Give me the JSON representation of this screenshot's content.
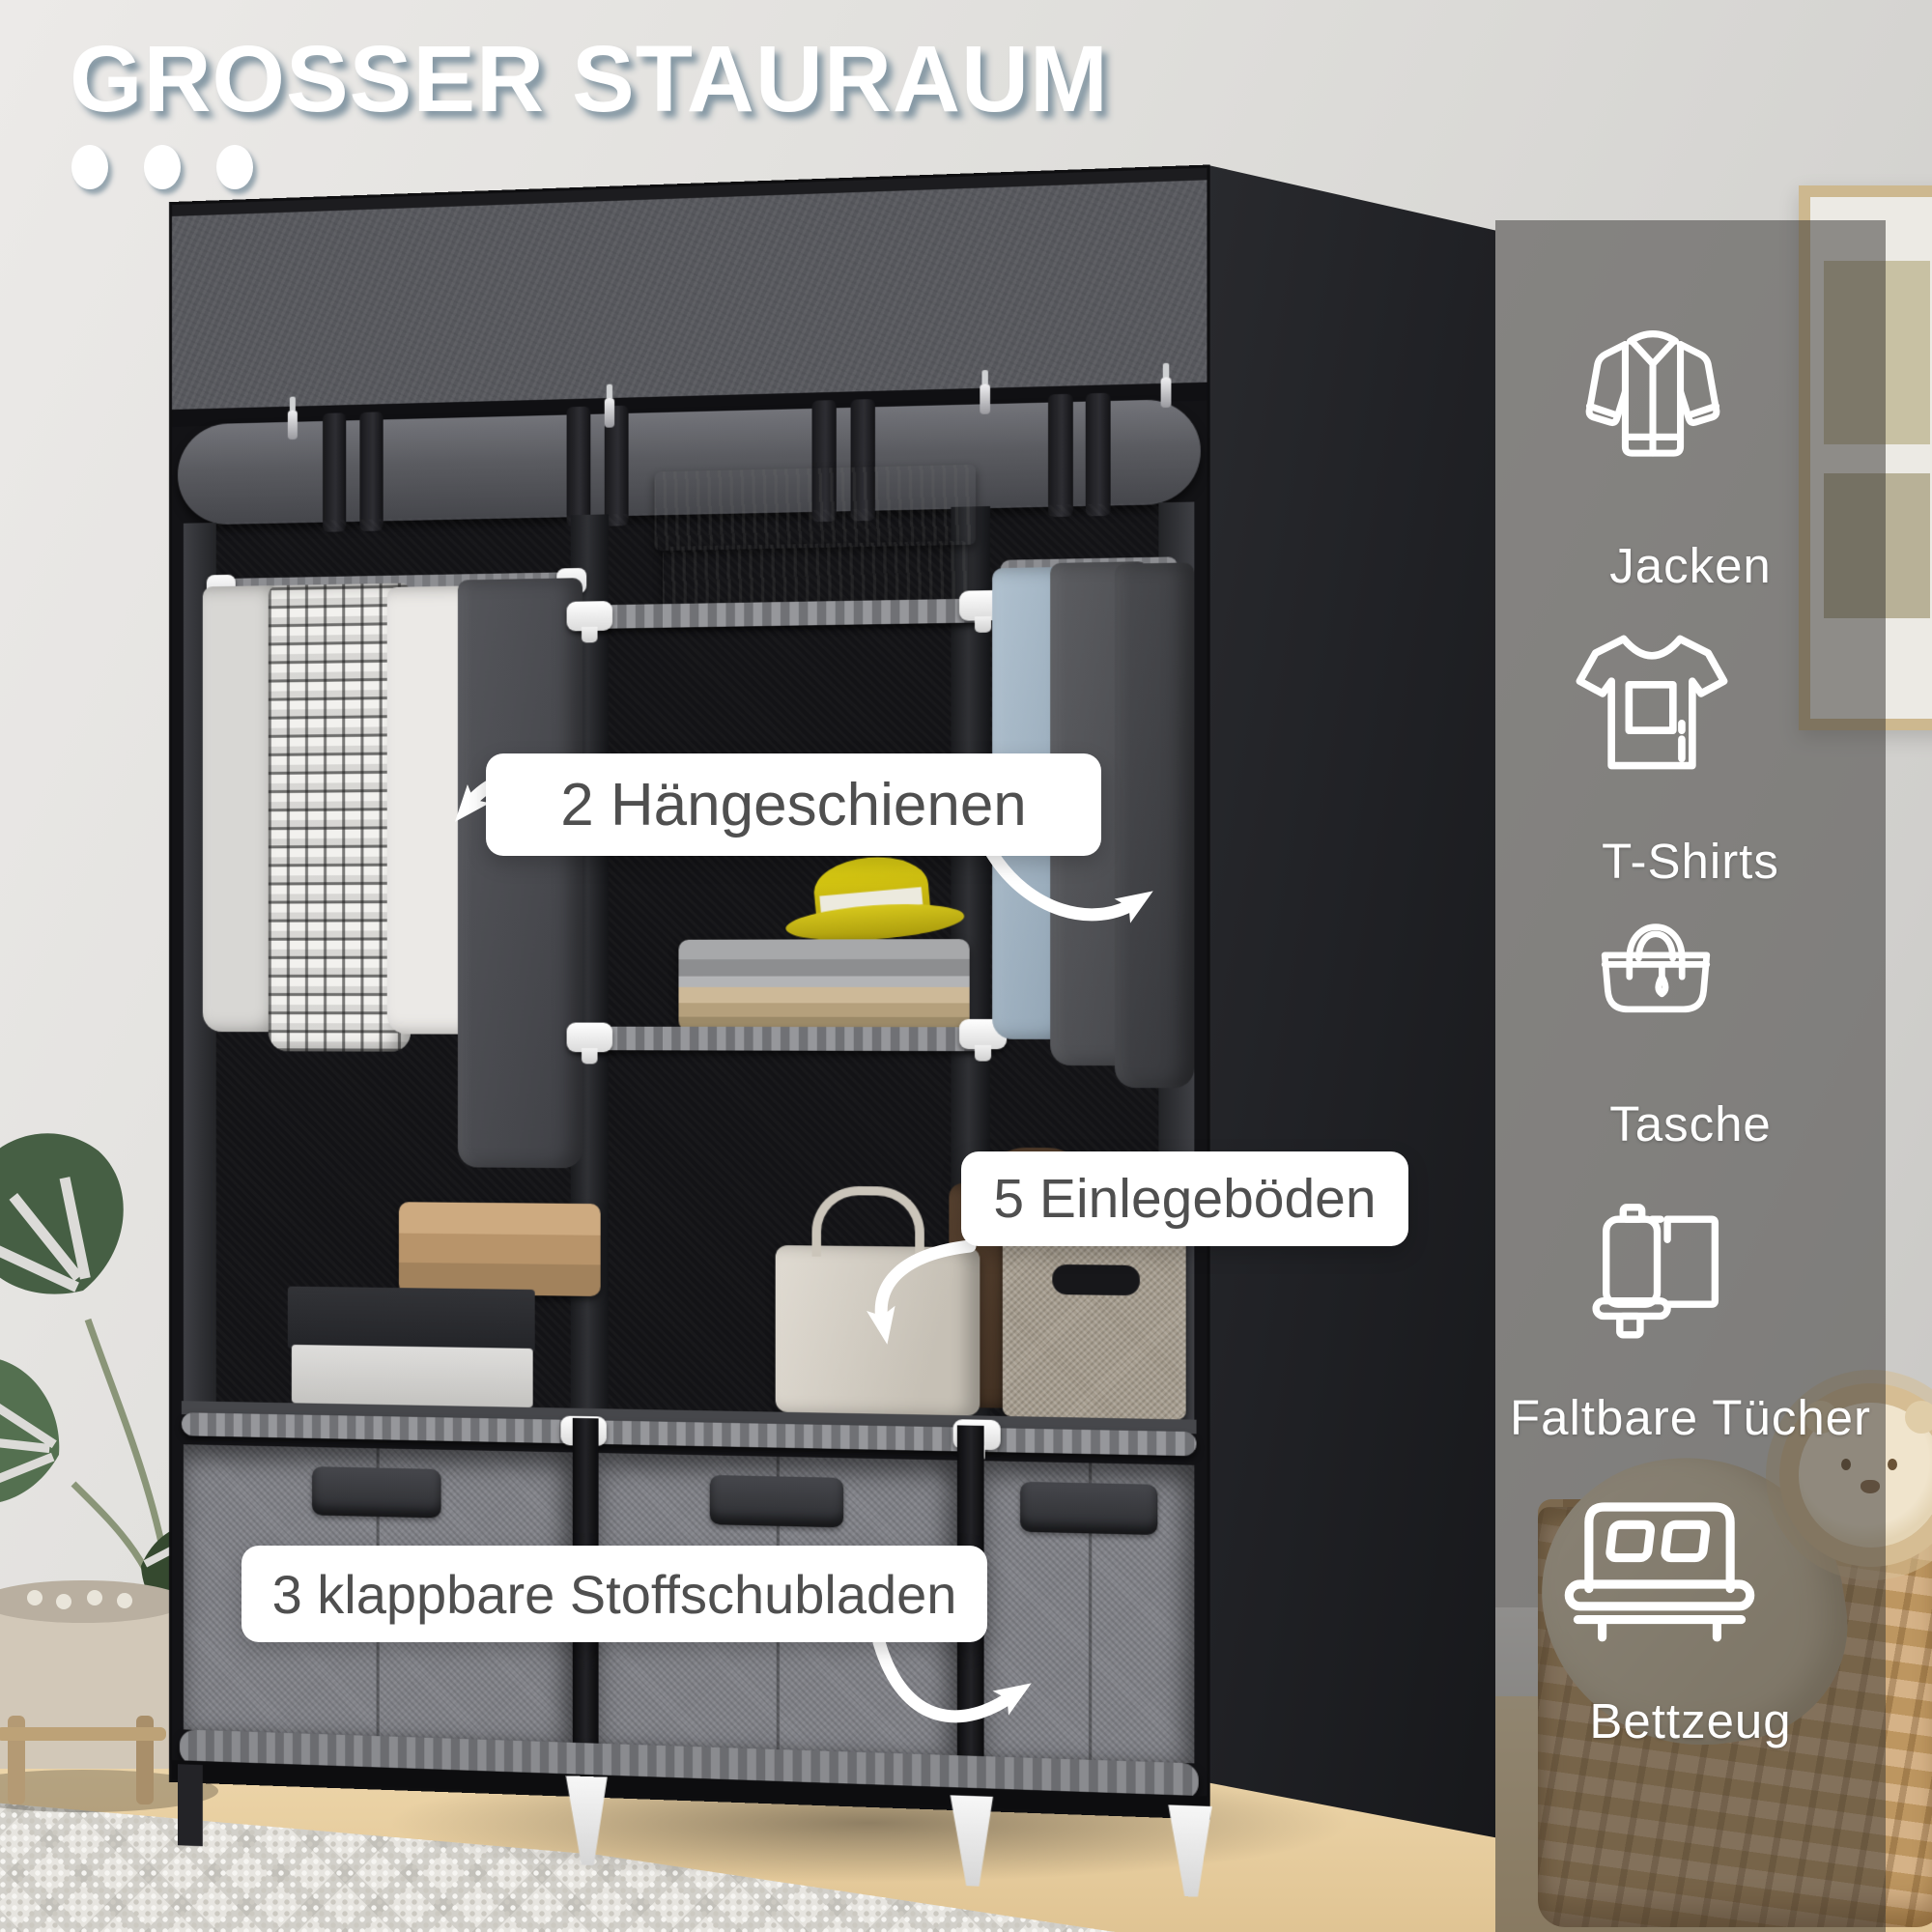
{
  "title": "GROSSER STAURAUM",
  "callouts": {
    "hanging_rails": "2 Hängeschienen",
    "shelves": "5 Einlegeböden",
    "drawers": "3 klappbare Stoffschubladen"
  },
  "features": [
    {
      "icon": "jacket-icon",
      "label": "Jacken"
    },
    {
      "icon": "tshirt-icon",
      "label": "T-Shirts"
    },
    {
      "icon": "bag-icon",
      "label": "Tasche"
    },
    {
      "icon": "folded-towels-icon",
      "label": "Faltbare Tücher"
    },
    {
      "icon": "bed-icon",
      "label": "Bettzeug"
    }
  ],
  "colors": {
    "title_text": "#ffffff",
    "title_shadow": "#8da3ae",
    "callout_bg": "#ffffff",
    "callout_text": "#4f4f4f",
    "icon_color": "#ffffff",
    "overlay_panel": "rgba(56,54,52,0.52)",
    "hat_accent": "#d2bf1e",
    "wardrobe_fabric": "#57585d",
    "drawer_fabric": "#83848a"
  }
}
